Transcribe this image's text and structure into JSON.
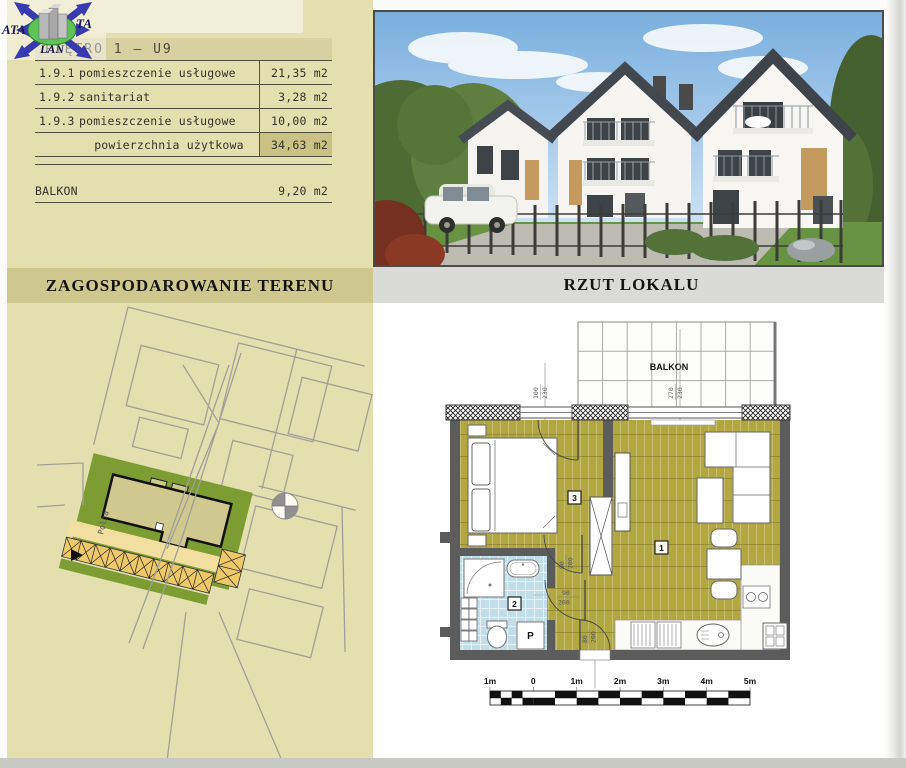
{
  "watermark": {
    "part_left": "ATA",
    "part_right": "TA",
    "part_bottom": "LAN"
  },
  "area_table": {
    "title": "PIĘTRO 1  –  U9",
    "rows": [
      {
        "no": "1.9.1",
        "name": "pomieszczenie usługowe",
        "area": "21,35 m2"
      },
      {
        "no": "1.9.2",
        "name": "sanitariat",
        "area": "3,28 m2"
      },
      {
        "no": "1.9.3",
        "name": "pomieszczenie usługowe",
        "area": "10,00 m2"
      }
    ],
    "total_row": {
      "name": "powierzchnia użytkowa",
      "area": "34,63 m2"
    },
    "balcony_row": {
      "name": "BALKON",
      "area": "9,20 m2"
    }
  },
  "section_headers": {
    "left": "ZAGOSPODAROWANIE TERENU",
    "right": "RZUT LOKALU"
  },
  "site_plan": {
    "street_label": "Polna"
  },
  "floor_plan": {
    "balcony_label": "BALKON",
    "rooms": [
      {
        "id": "1"
      },
      {
        "id": "2"
      },
      {
        "id": "3"
      }
    ],
    "washer_label": "P",
    "window_dims": [
      {
        "w": "100",
        "h": "230"
      },
      {
        "w": "270",
        "h": "230"
      }
    ],
    "door_dims": [
      {
        "w": "90",
        "h": "200"
      },
      {
        "w": "90",
        "h": "200"
      },
      {
        "w": "80",
        "h": "200"
      }
    ],
    "scale": {
      "labels": [
        "1m",
        "0",
        "1m",
        "2m",
        "3m",
        "4m",
        "5m"
      ]
    }
  },
  "colors": {
    "panel_tan": "#e3dfae",
    "band_tan": "#cfc88e",
    "band_grey": "#dadad8",
    "floor_olive": "#b3a840",
    "bath_blue": "#c2dfe9",
    "wall_grey": "#5c5c5c",
    "parcel_green": "#7d9c33",
    "driveway_yellow": "#f2dfa0",
    "parking_orange": "#eec96a",
    "logo_blue": "#3a3ab0",
    "logo_green": "#5cc455"
  }
}
